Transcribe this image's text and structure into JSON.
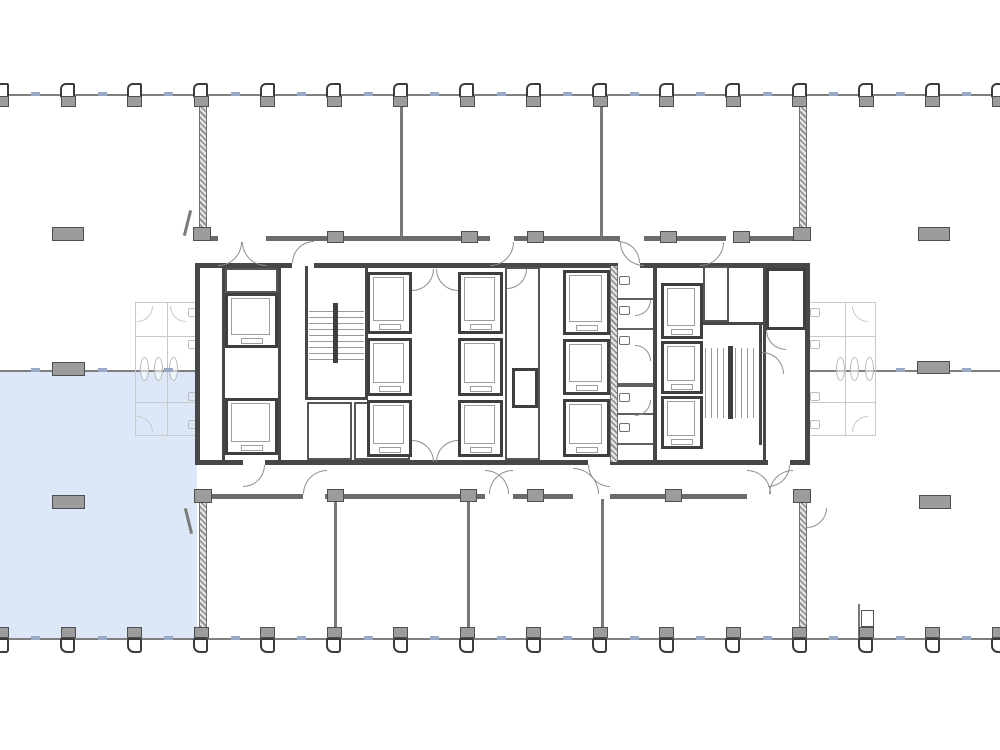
{
  "plan": {
    "canvas": {
      "width": 1000,
      "height": 750,
      "background": "#ffffff"
    },
    "colors": {
      "highlight_blue": "#dce8f8",
      "wall_dark": "#474747",
      "wall_medium": "#6b6b6b",
      "grid_line": "#7f7f7f",
      "column_fill": "#9c9c9c",
      "mullion_tick": "#9aa9c7",
      "door_arc": "#8f8f8f",
      "ghost": "#c9c9c9"
    },
    "highlight_suite": {
      "rect": [
        0,
        372,
        197,
        266
      ],
      "color": "#dce8f8",
      "label": "highlighted-available-suite"
    },
    "structural_grid": {
      "top_line_y": 94,
      "mid_line_y": 370,
      "bottom_line_y": 638,
      "grid_lines": [
        [
          0,
          94,
          1000,
          2
        ],
        [
          0,
          370,
          1000,
          2
        ],
        [
          0,
          638,
          1000,
          2
        ]
      ],
      "column_xs": [
        2,
        68.5,
        135,
        201.5,
        268,
        334.5,
        401,
        467.5,
        534,
        600.5,
        667,
        733.5,
        800,
        866.5,
        933,
        999.5
      ],
      "mid_tick_xs": [
        35,
        101.5,
        168,
        899.5,
        966
      ]
    },
    "free_columns": [
      [
        52,
        227,
        32,
        14
      ],
      [
        918,
        227,
        32,
        14
      ],
      [
        52,
        362,
        33,
        14
      ],
      [
        917,
        361,
        33,
        13
      ],
      [
        52,
        495,
        33,
        14
      ],
      [
        919,
        495,
        32,
        14
      ]
    ],
    "walls": {
      "dark": [
        [
          195,
          263,
          5,
          202
        ],
        [
          805,
          263,
          5,
          202
        ],
        [
          195,
          263,
          97,
          5
        ],
        [
          314,
          263,
          304,
          5
        ],
        [
          640,
          263,
          170,
          5
        ],
        [
          195,
          460,
          48,
          5
        ],
        [
          265,
          460,
          323,
          5
        ],
        [
          610,
          460,
          158,
          5
        ],
        [
          790,
          460,
          20,
          5
        ],
        [
          222,
          266,
          3,
          196
        ],
        [
          278,
          266,
          3,
          196
        ],
        [
          305,
          266,
          3,
          134
        ],
        [
          365,
          266,
          3,
          134
        ],
        [
          305,
          397,
          63,
          3
        ],
        [
          653,
          266,
          4,
          196
        ],
        [
          763,
          266,
          3,
          196
        ],
        [
          701,
          322,
          62,
          3
        ],
        [
          759,
          322,
          3,
          123
        ]
      ],
      "medium": [
        [
          195,
          236,
          23,
          5
        ],
        [
          266,
          236,
          224,
          5
        ],
        [
          514,
          236,
          106,
          5
        ],
        [
          644,
          236,
          82,
          5
        ],
        [
          750,
          236,
          60,
          5
        ],
        [
          195,
          494,
          108,
          5
        ],
        [
          325,
          494,
          160,
          5
        ],
        [
          513,
          494,
          60,
          5
        ],
        [
          610,
          494,
          137,
          5
        ],
        [
          793,
          494,
          17,
          5
        ]
      ],
      "thin": [
        [
          400,
          102,
          3,
          135
        ],
        [
          600,
          102,
          3,
          135
        ],
        [
          334,
          499,
          3,
          139
        ],
        [
          467,
          499,
          3,
          139
        ],
        [
          601,
          499,
          3,
          139
        ],
        [
          858,
          604,
          2,
          34
        ]
      ],
      "hatched": [
        [
          199,
          96,
          8,
          141
        ],
        [
          799,
          96,
          8,
          141
        ],
        [
          199,
          499,
          8,
          139
        ],
        [
          799,
          499,
          8,
          139
        ],
        [
          610,
          266,
          8,
          196
        ]
      ]
    },
    "wall_columns": [
      [
        327,
        231,
        17,
        12
      ],
      [
        461,
        231,
        17,
        12
      ],
      [
        527,
        231,
        17,
        12
      ],
      [
        660,
        231,
        17,
        12
      ],
      [
        733,
        231,
        17,
        12
      ],
      [
        193,
        227,
        18,
        14
      ],
      [
        793,
        227,
        18,
        14
      ],
      [
        327,
        489,
        17,
        13
      ],
      [
        460,
        489,
        17,
        13
      ],
      [
        527,
        489,
        17,
        13
      ],
      [
        665,
        489,
        17,
        13
      ],
      [
        793,
        489,
        18,
        14
      ],
      [
        194,
        489,
        18,
        14
      ]
    ],
    "core": {
      "bg_rect": [
        197,
        265,
        611,
        198
      ],
      "elevator_cells": [
        [
          225,
          293,
          53,
          55
        ],
        [
          225,
          398,
          53,
          57
        ],
        [
          367,
          272,
          45,
          62
        ],
        [
          367,
          338,
          45,
          58
        ],
        [
          367,
          400,
          45,
          57
        ],
        [
          458,
          272,
          45,
          62
        ],
        [
          458,
          338,
          45,
          58
        ],
        [
          458,
          400,
          45,
          57
        ],
        [
          563,
          270,
          47,
          65
        ],
        [
          563,
          339,
          47,
          56
        ],
        [
          563,
          399,
          47,
          58
        ],
        [
          661,
          283,
          42,
          56
        ],
        [
          661,
          341,
          42,
          53
        ],
        [
          661,
          396,
          42,
          53
        ]
      ],
      "plain_rooms": [
        [
          225,
          268,
          53,
          25
        ],
        [
          307,
          402,
          45,
          58
        ],
        [
          354,
          402,
          56,
          58
        ],
        [
          505,
          267,
          35,
          193
        ],
        [
          703,
          266,
          26,
          56
        ]
      ],
      "dark_rooms": [
        [
          766,
          268,
          40,
          62
        ],
        [
          512,
          368,
          26,
          40
        ]
      ],
      "stairs": [
        {
          "treads": [
            309,
            311,
            55,
            52
          ],
          "dir": "h",
          "rail": [
            333,
            303,
            5,
            60
          ]
        },
        {
          "treads": [
            705,
            348,
            52,
            70
          ],
          "dir": "v",
          "rail": [
            728,
            346,
            5,
            73
          ]
        }
      ],
      "stall_partitions": [
        [
          617,
          298,
          36,
          2
        ],
        [
          617,
          328,
          36,
          2
        ],
        [
          617,
          383,
          36,
          4
        ],
        [
          617,
          413,
          36,
          2
        ],
        [
          617,
          443,
          36,
          2
        ]
      ],
      "toilets": [
        [
          619,
          276,
          11,
          9
        ],
        [
          619,
          306,
          11,
          9
        ],
        [
          619,
          336,
          11,
          9
        ],
        [
          619,
          393,
          11,
          9
        ],
        [
          619,
          423,
          11,
          9
        ]
      ]
    },
    "ghost_layouts": {
      "frames": [
        [
          135,
          302,
          65,
          134
        ],
        [
          808,
          302,
          68,
          134
        ]
      ],
      "lines": [
        [
          167,
          302,
          1,
          134
        ],
        [
          135,
          336,
          65,
          1
        ],
        [
          135,
          402,
          65,
          1
        ],
        [
          845,
          302,
          1,
          134
        ],
        [
          808,
          336,
          68,
          1
        ],
        [
          808,
          402,
          68,
          1
        ]
      ],
      "toilets": [
        [
          188,
          308,
          10,
          9
        ],
        [
          188,
          340,
          10,
          9
        ],
        [
          188,
          392,
          10,
          9
        ],
        [
          188,
          420,
          10,
          9
        ],
        [
          810,
          308,
          10,
          9
        ],
        [
          810,
          340,
          10,
          9
        ],
        [
          810,
          392,
          10,
          9
        ],
        [
          810,
          420,
          10,
          9
        ]
      ],
      "sinks": [
        [
          140,
          357,
          9,
          24
        ],
        [
          154,
          357,
          9,
          24
        ],
        [
          169,
          357,
          9,
          24
        ],
        [
          836,
          357,
          9,
          24
        ],
        [
          850,
          357,
          9,
          24
        ],
        [
          865,
          357,
          9,
          24
        ]
      ],
      "arcs": [
        [
          137,
          306,
          16,
          16,
          "br"
        ],
        [
          137,
          416,
          16,
          16,
          "tr"
        ],
        [
          170,
          306,
          16,
          16,
          "bl"
        ],
        [
          852,
          306,
          16,
          16,
          "bl"
        ],
        [
          852,
          416,
          16,
          16,
          "tl"
        ]
      ]
    },
    "door_arcs": [
      [
        218,
        242,
        24,
        24,
        "br"
      ],
      [
        242,
        242,
        24,
        24,
        "bl"
      ],
      [
        490,
        242,
        24,
        24,
        "br"
      ],
      [
        620,
        242,
        24,
        24,
        "bl"
      ],
      [
        700,
        242,
        24,
        24,
        "br"
      ],
      [
        292,
        241,
        22,
        22,
        "tl"
      ],
      [
        618,
        241,
        22,
        22,
        "tr"
      ],
      [
        243,
        465,
        22,
        22,
        "br"
      ],
      [
        588,
        465,
        22,
        22,
        "bl"
      ],
      [
        768,
        465,
        22,
        22,
        "br"
      ],
      [
        303,
        470,
        24,
        24,
        "tl"
      ],
      [
        485,
        470,
        24,
        24,
        "tr"
      ],
      [
        489,
        470,
        24,
        24,
        "tl"
      ],
      [
        573,
        468,
        26,
        26,
        "tr"
      ],
      [
        747,
        470,
        24,
        24,
        "tr"
      ],
      [
        769,
        470,
        24,
        24,
        "tl"
      ],
      [
        807,
        508,
        20,
        20,
        "br"
      ],
      [
        412,
        269,
        22,
        22,
        "br"
      ],
      [
        436,
        269,
        22,
        22,
        "bl"
      ],
      [
        412,
        440,
        22,
        22,
        "tr"
      ],
      [
        436,
        440,
        22,
        22,
        "tl"
      ],
      [
        507,
        269,
        20,
        20,
        "br"
      ],
      [
        635,
        300,
        16,
        16,
        "br"
      ],
      [
        635,
        345,
        16,
        16,
        "tr"
      ],
      [
        635,
        400,
        16,
        16,
        "br"
      ],
      [
        762,
        352,
        22,
        22,
        "tr"
      ],
      [
        766,
        330,
        20,
        20,
        "bl"
      ]
    ],
    "door_leaves": [
      [
        187,
        508,
        3,
        26,
        -14
      ],
      [
        186,
        210,
        3,
        26,
        14
      ]
    ],
    "misc_boxes": [
      [
        861,
        610,
        13,
        17
      ]
    ]
  }
}
